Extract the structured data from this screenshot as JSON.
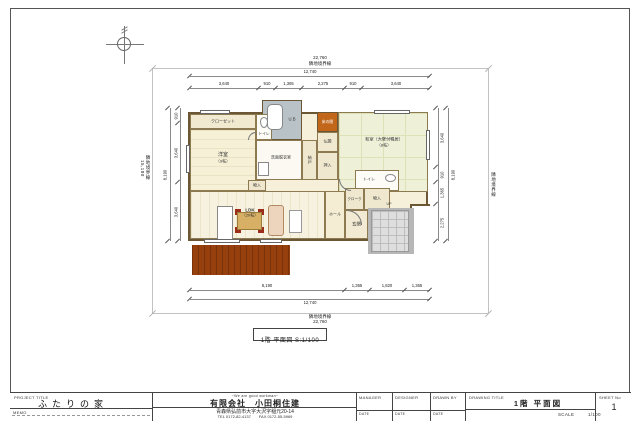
{
  "plan_label": "1階 平面図 S:1/100",
  "boundary": {
    "top_value": "22,760",
    "top_label": "隣地境界線",
    "bottom_label": "隣地境界線",
    "bottom_value": "22,760",
    "left_value": "15,180",
    "left_label": "隣地境界線",
    "right_label": "隣地境界線"
  },
  "dims": {
    "top_overall": "12,740",
    "top_segments": [
      "3,640",
      "910",
      "1,365",
      "2,275",
      "910",
      "3,640"
    ],
    "bottom_segments": [
      "8,190",
      "1,365",
      "1,820",
      "1,365"
    ],
    "bottom_overall": "12,740",
    "left_overall": "8,190",
    "left_segments": [
      "910",
      "3,640",
      "3,640"
    ],
    "right_overall": "8,190",
    "right_segments": [
      "3,640",
      "910",
      "1,365",
      "2,275"
    ]
  },
  "rooms": {
    "closet": "クローゼット",
    "yoshitsu": "洋室",
    "yoshitsu_size": "（9帖）",
    "toilet1": "トイレ",
    "toilet2": "トイレ",
    "washroom": "洗面脱衣室",
    "ub": "U.B",
    "tokonoma": "床の間",
    "butsuma": "仏間",
    "oshiire": "押入",
    "nando": "納戸",
    "washitsu": "和室（大壁付鴨居）",
    "washitsu_size": "（8帖）",
    "ldk": "LDK",
    "ldk_size": "（20帖）",
    "hall": "ホール",
    "cloak": "クローク",
    "monoire1": "物入",
    "monoire2": "物入",
    "genkan": "玄関",
    "up": "UP"
  },
  "titleblock": {
    "project_title_label": "PROJECT TITLE",
    "project_title": "ふたりの家",
    "memo_label": "MEMO",
    "company_slogan": "~We are good workman~",
    "company_name": "有限会社　小田桐住建",
    "company_address": "青森県弘前市大字大沢字稲元20-14",
    "company_tel": "TEL  0172-82-4137　　FAX  0172-55-5969",
    "manager_label": "MANAGER",
    "designer_label": "DESIGNER",
    "drawnby_label": "DRAWN BY",
    "date_label": "DATE",
    "drawing_title_label": "DRAWING TITLE",
    "drawing_title": "1階 平面図",
    "scale_label": "SCALE",
    "scale_value": "1/100",
    "sheet_label": "SHEET No",
    "sheet_value": "1"
  }
}
